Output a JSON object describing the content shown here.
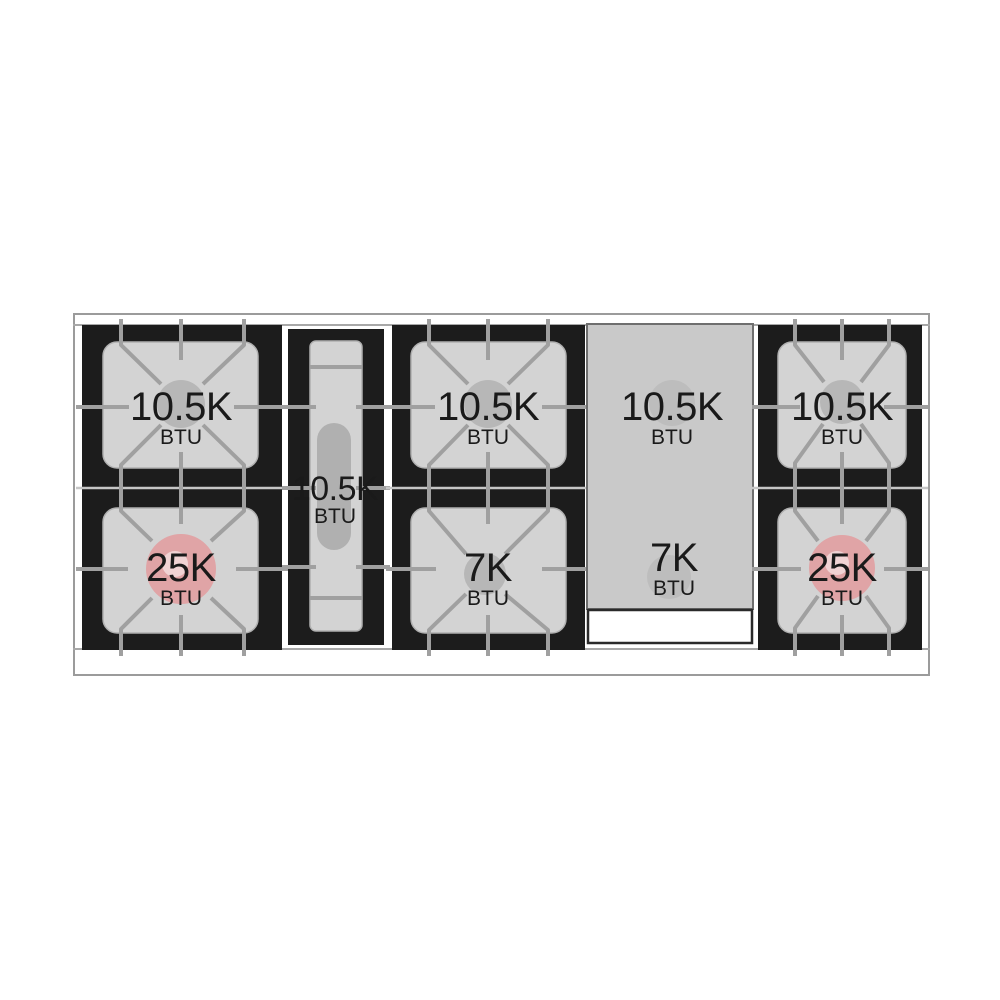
{
  "colors": {
    "frame_black": "#1c1c1c",
    "surface_gray": "#d3d3d3",
    "griddle_gray": "#c9c9c9",
    "grate_line_gray": "#a0a0a0",
    "burner_spot_gray": "#b7b7b7",
    "griddle_spot_gray": "#bdbdbd",
    "oval_burner_gray": "#b0b0b0",
    "high_btu_red": "#e0a4a6",
    "high_btu_red_inner": "#f0d3d4",
    "tray_white": "#ffffff"
  },
  "cooktop": {
    "sections": [
      {
        "name": "left-burner-pair",
        "burners": [
          {
            "value": "10.5K",
            "unit": "BTU"
          },
          {
            "value": "25K",
            "unit": "BTU"
          }
        ]
      },
      {
        "name": "center-oval-burner",
        "burners": [
          {
            "value": "10.5K",
            "unit": "BTU"
          }
        ]
      },
      {
        "name": "middle-burner-pair",
        "burners": [
          {
            "value": "10.5K",
            "unit": "BTU"
          },
          {
            "value": "7K",
            "unit": "BTU"
          }
        ]
      },
      {
        "name": "griddle",
        "burners": [
          {
            "value": "10.5K",
            "unit": "BTU"
          },
          {
            "value": "7K",
            "unit": "BTU"
          }
        ]
      },
      {
        "name": "right-burner-pair",
        "burners": [
          {
            "value": "10.5K",
            "unit": "BTU"
          },
          {
            "value": "25K",
            "unit": "BTU"
          }
        ]
      }
    ]
  }
}
